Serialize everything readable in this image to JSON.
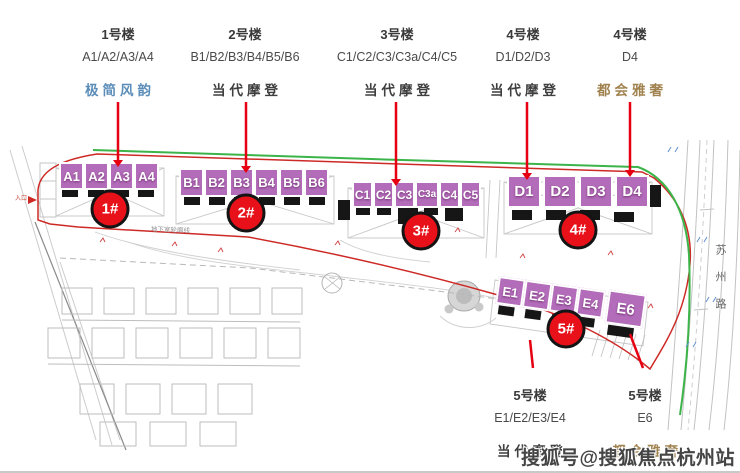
{
  "header": {
    "columns": [
      {
        "building": "1号楼",
        "units": "A1/A2/A3/A4",
        "style": "极简风韵"
      },
      {
        "building": "2号楼",
        "units": "B1/B2/B3/B4/B5/B6",
        "style": "当代摩登"
      },
      {
        "building": "3号楼",
        "units": "C1/C2/C3/C3a/C4/C5",
        "style": "当代摩登"
      },
      {
        "building": "4号楼",
        "units": "D1/D2/D3",
        "style": "当代摩登"
      },
      {
        "building": "4号楼",
        "units": "D4",
        "style": "都会雅奢"
      }
    ]
  },
  "footer": {
    "columns": [
      {
        "building": "5号楼",
        "units": "E1/E2/E3/E4",
        "style": "当代摩登"
      },
      {
        "building": "5号楼",
        "units": "E6",
        "style": "都会雅奢"
      }
    ]
  },
  "map": {
    "buildings": [
      {
        "marker": "1#",
        "units": [
          "A1",
          "A2",
          "A3",
          "A4"
        ]
      },
      {
        "marker": "2#",
        "units": [
          "B1",
          "B2",
          "B3",
          "B4",
          "B5",
          "B6"
        ]
      },
      {
        "marker": "3#",
        "units": [
          "C1",
          "C2",
          "C3",
          "C3a",
          "C4",
          "C5"
        ]
      },
      {
        "marker": "4#",
        "units": [
          "D1",
          "D2",
          "D3",
          "D4"
        ]
      },
      {
        "marker": "5#",
        "units": [
          "E1",
          "E2",
          "E3",
          "E4",
          "E6"
        ]
      }
    ],
    "labels": {
      "underground_outline": "地下室轮廓线",
      "road": "苏州路",
      "entrance": "入口"
    }
  },
  "watermark": "搜狐号@搜狐焦点杭州站",
  "colors": {
    "unit_box_purple": "#b36cb9",
    "marker_red": "#e8111a",
    "leader_red": "#e60012",
    "boundary_red": "#cd2a26",
    "greenbelt_green": "#3cb44a",
    "style_blue": "#5b8db8",
    "style_gold": "#a0824f"
  }
}
